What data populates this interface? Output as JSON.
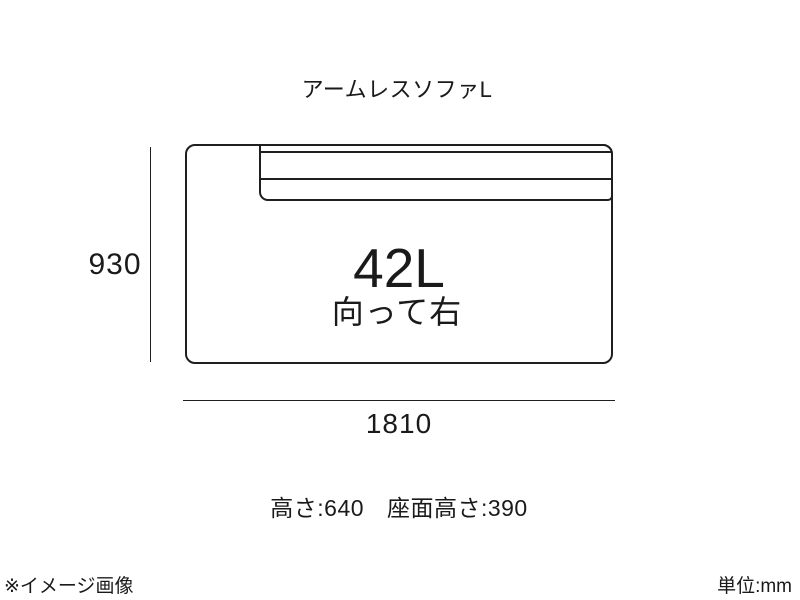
{
  "page": {
    "title": "アームレスソファL"
  },
  "diagram": {
    "model": "42L",
    "orientation": "向って右",
    "dimensions": {
      "width_mm": "1810",
      "depth_mm": "930"
    }
  },
  "specs": {
    "height": "高さ:640",
    "seat_height": "座面高さ:390"
  },
  "footer": {
    "note": "※イメージ画像",
    "unit": "単位:mm"
  },
  "colors": {
    "line": "#1f1f1f",
    "text": "#1a1a1a",
    "background": "#ffffff"
  }
}
